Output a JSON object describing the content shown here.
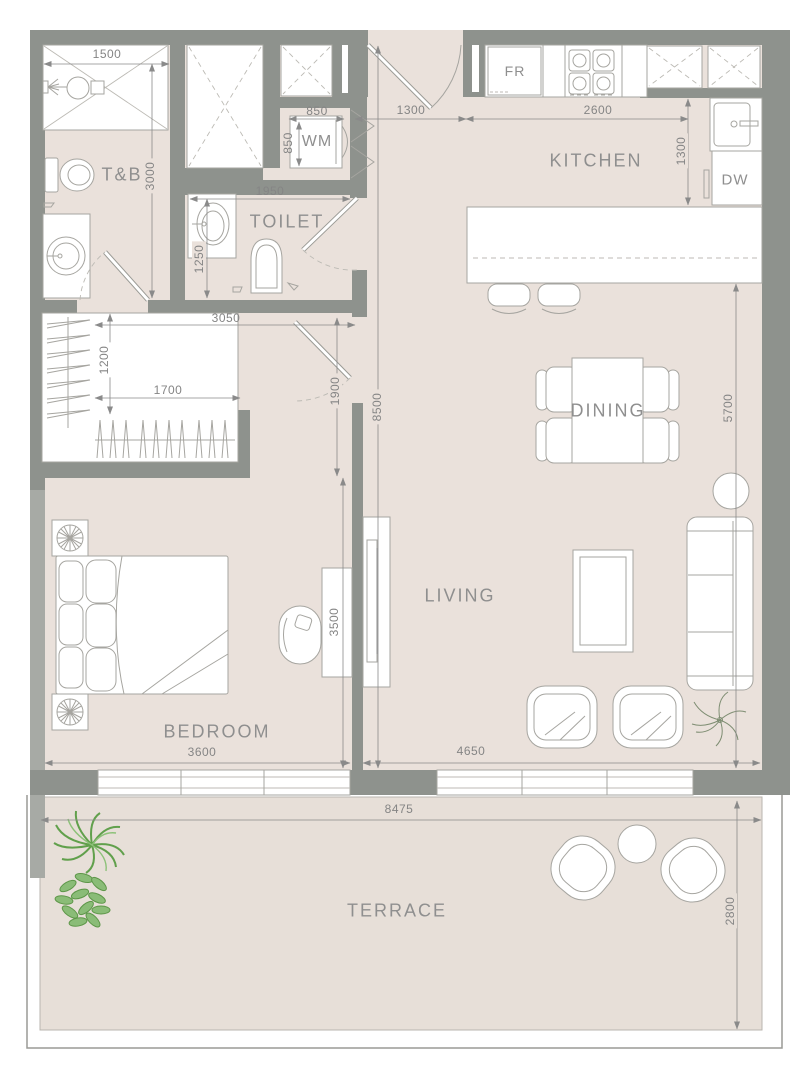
{
  "colors": {
    "wall": "#8e928d",
    "wall_light": "#a7aaa5",
    "floor": "#eae1db",
    "terrace_floor": "#e7dfd8",
    "fixture_outline": "#a6a5a0",
    "room_label": "#8f8f8f",
    "dimension_text": "#858585",
    "plant_green": "#61a04c",
    "plant_olive": "#7e8d72"
  },
  "rooms": {
    "tb": "T&B",
    "toilet": "TOILET",
    "kitchen": "KITCHEN",
    "dining": "DINING",
    "living": "LIVING",
    "bedroom": "BEDROOM",
    "terrace": "TERRACE"
  },
  "appliances": {
    "fridge": "FR",
    "washer": "WM",
    "dishwasher": "DW"
  },
  "dimensions_mm": {
    "shower_width": "1500",
    "tb_depth": "3000",
    "wm_niche_width": "850",
    "wm_niche_depth": "850",
    "toilet_width": "1950",
    "toilet_depth": "1250",
    "entry_hall_width": "1300",
    "kitchen_counter_length": "2600",
    "kitchen_depth": "1300",
    "hallway_length": "3050",
    "wardrobe_depth": "1200",
    "wardrobe_length": "1700",
    "bedroom_opening": "1900",
    "apartment_depth": "8500",
    "living_dining_length": "5700",
    "bedroom_length": "3500",
    "bedroom_width": "3600",
    "living_width": "4650",
    "terrace_width": "8475",
    "terrace_depth": "2800"
  }
}
